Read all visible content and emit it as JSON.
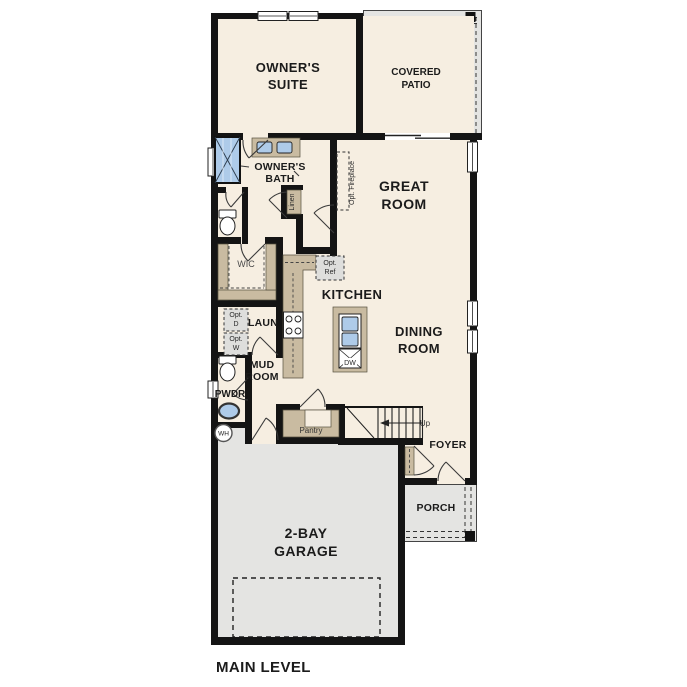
{
  "plan_title": "MAIN LEVEL",
  "colors": {
    "wall": "#141414",
    "floor": "#F6EEE1",
    "exterior": "#E4E4E2",
    "cabinet": "#C9BBA1",
    "fixture_blue": "#AECBE9",
    "optional_fill": "#DEDEDC"
  },
  "rooms": {
    "owners_suite": {
      "line1": "OWNER'S",
      "line2": "SUITE"
    },
    "covered_patio": {
      "line1": "COVERED",
      "line2": "PATIO"
    },
    "owners_bath": {
      "line1": "OWNER'S",
      "line2": "BATH"
    },
    "great_room": {
      "line1": "GREAT",
      "line2": "ROOM"
    },
    "kitchen": {
      "label": "KITCHEN"
    },
    "dining_room": {
      "line1": "DINING",
      "line2": "ROOM"
    },
    "wic": {
      "label": "WIC"
    },
    "laundry": {
      "label": "LAUN"
    },
    "mud_room": {
      "line1": "MUD",
      "line2": "ROOM"
    },
    "powder": {
      "label": "PWDR"
    },
    "pantry": {
      "label": "Pantry"
    },
    "foyer": {
      "label": "FOYER"
    },
    "porch": {
      "label": "PORCH"
    },
    "garage": {
      "line1": "2-BAY",
      "line2": "GARAGE"
    },
    "linen": {
      "label": "Linen"
    }
  },
  "annotations": {
    "stairs_direction": "Up",
    "opt_fireplace": "Opt. Fireplace",
    "opt_ref_line1": "Opt.",
    "opt_ref_line2": "Ref",
    "opt_dryer_line1": "Opt.",
    "opt_dryer_line2": "D",
    "opt_washer_line1": "Opt.",
    "opt_washer_line2": "W",
    "dishwasher": "DW",
    "water_heater": "WH"
  }
}
